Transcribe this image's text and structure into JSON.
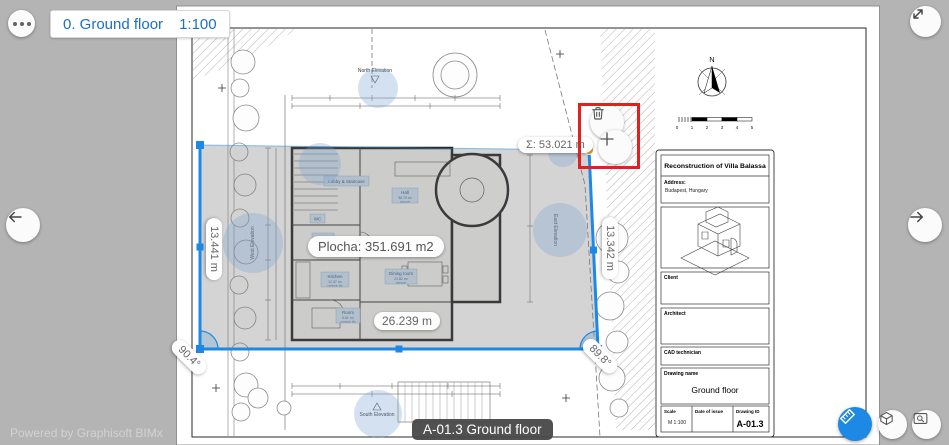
{
  "topbar": {
    "floor_name": "0. Ground floor",
    "scale": "1:100"
  },
  "icons": {
    "more": "ellipsis",
    "fullscreen": "expand-diagonal-arrow",
    "prev": "arrow-left",
    "next": "arrow-right",
    "delete_vertex": "trash",
    "add_vertex": "plus",
    "measure": "ruler",
    "model3d": "house-3d",
    "zoom_window": "zoom-rectangle"
  },
  "measurement": {
    "sum": "Σ: 53.021 m",
    "area": "Plocha: 351.691 m2",
    "dim_left": "13.441 m",
    "dim_bottom": "26.239 m",
    "dim_right": "13.342 m",
    "angle_left": "90.4°",
    "angle_right": "89.8°"
  },
  "plan": {
    "compass": "N",
    "scalebar": [
      "0",
      "1",
      "2",
      "3",
      "4",
      "5"
    ],
    "elevations": {
      "north": "North Elevation",
      "south": "South Elevation",
      "west": "West Elevation",
      "east": "East Elevation"
    },
    "rooms": [
      {
        "name": "Lobby & Staircase",
        "info": ""
      },
      {
        "name": "Hall",
        "info": "38.79 m²",
        "finish": "parquet"
      },
      {
        "name": "WC",
        "info": ""
      },
      {
        "name": "Pantry",
        "info": ""
      },
      {
        "name": "Kitchen",
        "info": "12.47 m²",
        "finish": "ceramic tile"
      },
      {
        "name": "Dining room",
        "info": "24.82 m²",
        "finish": "parquet"
      },
      {
        "name": "Room",
        "info": "8.81 m²",
        "finish": "ceramic tile"
      }
    ]
  },
  "title_block": {
    "title": "Reconstruction of Villa Balassa",
    "address_label": "Address:",
    "address_value": "Budapest, Hungary",
    "client_label": "Client",
    "architect_label": "Architect",
    "cad_label": "CAD technician",
    "drawing_name_label": "Drawing name",
    "drawing_name": "Ground floor",
    "scale_label": "Scale",
    "scale_value": "M 1:100",
    "date_label": "Date of issue",
    "id_label": "Drawing ID",
    "id_value": "A-01.3"
  },
  "footer": {
    "powered_by": "Powered by Graphisoft BIMx",
    "drawing_tooltip": "A-01.3 Ground floor"
  },
  "colors": {
    "accent_blue": "#1e88e5",
    "vertex_orange": "#f09e1e",
    "highlight_red": "#e41f1f",
    "hotspot_blue": "rgba(125,165,210,0.33)",
    "selection_gray": "rgba(120,120,120,0.32)"
  }
}
